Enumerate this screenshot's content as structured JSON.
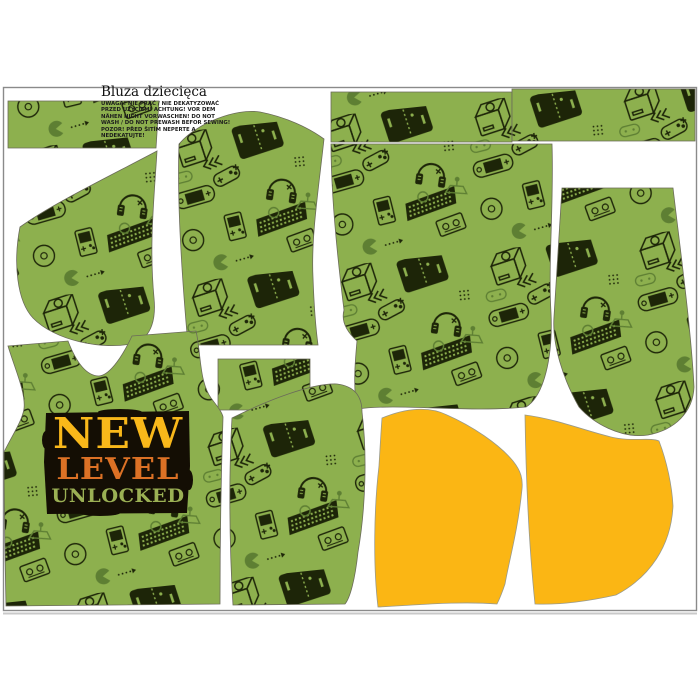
{
  "panel": {
    "title": "Bluza dziecięca",
    "care_warning_lines": [
      "UWAGA! NIE PRAĆ / NIE DEKATYZOWAĆ",
      "PRZED UŻYCIEM! ACHTUNG! VOR DEM",
      "NÄHEN NICHT VORWASCHEN! DO NOT",
      "WASH / DO NOT PREWASH BEFOR SEWING!",
      "POZOR! PŘED ŠITÍM NEPERTE A",
      "NEDEKATUJTE!"
    ],
    "print_graphic": {
      "word1": "NEW",
      "word2": "LEVEL",
      "word3": "UNLOCKED"
    },
    "colors": {
      "background": "#FFFFFF",
      "fabric_green": "#8DB04E",
      "doodle_dark": "#1D2508",
      "doodle_mid": "#5E7F33",
      "hood_yellow": "#FBB614",
      "logo_word1": "#F9B81A",
      "logo_word2": "#DC7125",
      "logo_word3": "#9BB054",
      "logo_background": "#140E04",
      "page_border": "#8A8A8A"
    }
  }
}
